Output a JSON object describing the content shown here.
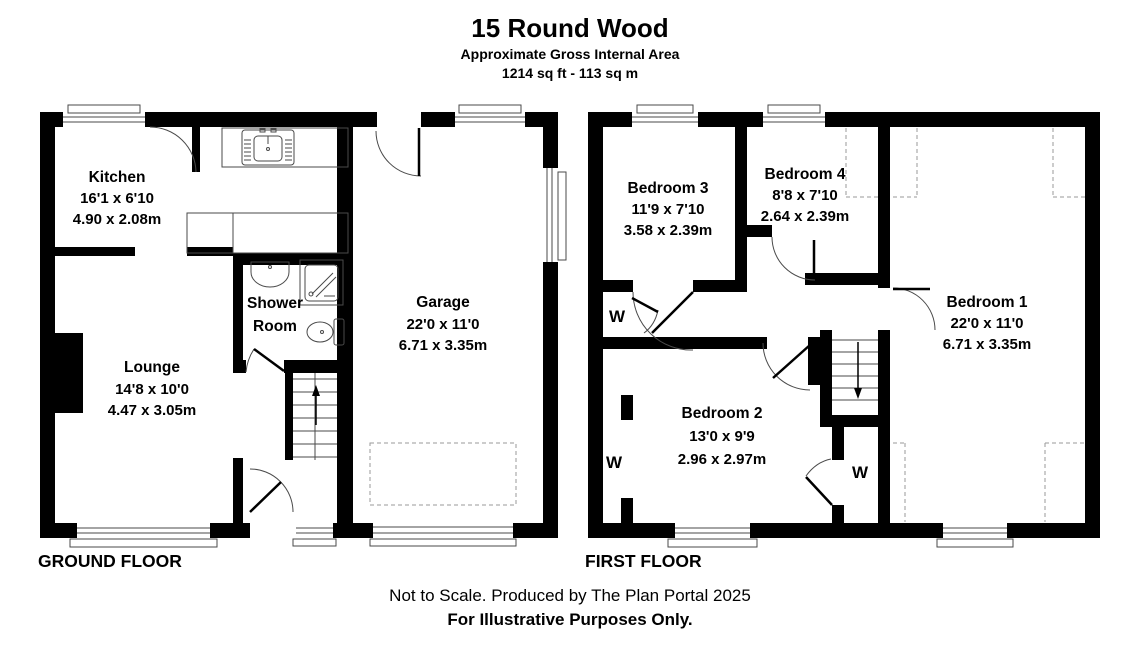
{
  "header": {
    "title": "15 Round Wood",
    "subtitle": "Approximate Gross Internal Area",
    "area": "1214 sq ft - 113 sq m"
  },
  "floors": {
    "ground": {
      "label": "GROUND FLOOR"
    },
    "first": {
      "label": "FIRST FLOOR"
    }
  },
  "rooms": {
    "kitchen": {
      "name": "Kitchen",
      "imperial": "16'1 x 6'10",
      "metric": "4.90 x 2.08m"
    },
    "shower": {
      "name_line1": "Shower",
      "name_line2": "Room"
    },
    "lounge": {
      "name": "Lounge",
      "imperial": "14'8 x 10'0",
      "metric": "4.47 x 3.05m"
    },
    "garage": {
      "name": "Garage",
      "imperial": "22'0 x 11'0",
      "metric": "6.71 x 3.35m"
    },
    "bedroom1": {
      "name": "Bedroom 1",
      "imperial": "22'0 x 11'0",
      "metric": "6.71 x 3.35m"
    },
    "bedroom2": {
      "name": "Bedroom 2",
      "imperial": "13'0 x 9'9",
      "metric": "2.96 x 2.97m"
    },
    "bedroom3": {
      "name": "Bedroom 3",
      "imperial": "11'9 x 7'10",
      "metric": "3.58 x 2.39m"
    },
    "bedroom4": {
      "name": "Bedroom 4",
      "imperial": "8'8 x 7'10",
      "metric": "2.64 x 2.39m"
    }
  },
  "wardrobe": {
    "label": "W"
  },
  "footer": {
    "line1": "Not to Scale. Produced by The Plan Portal 2025",
    "line2": "For Illustrative Purposes Only."
  },
  "colors": {
    "wall": "#000000",
    "line": "#4a4a4a",
    "dashed": "#9a9a9a",
    "background": "#ffffff"
  }
}
